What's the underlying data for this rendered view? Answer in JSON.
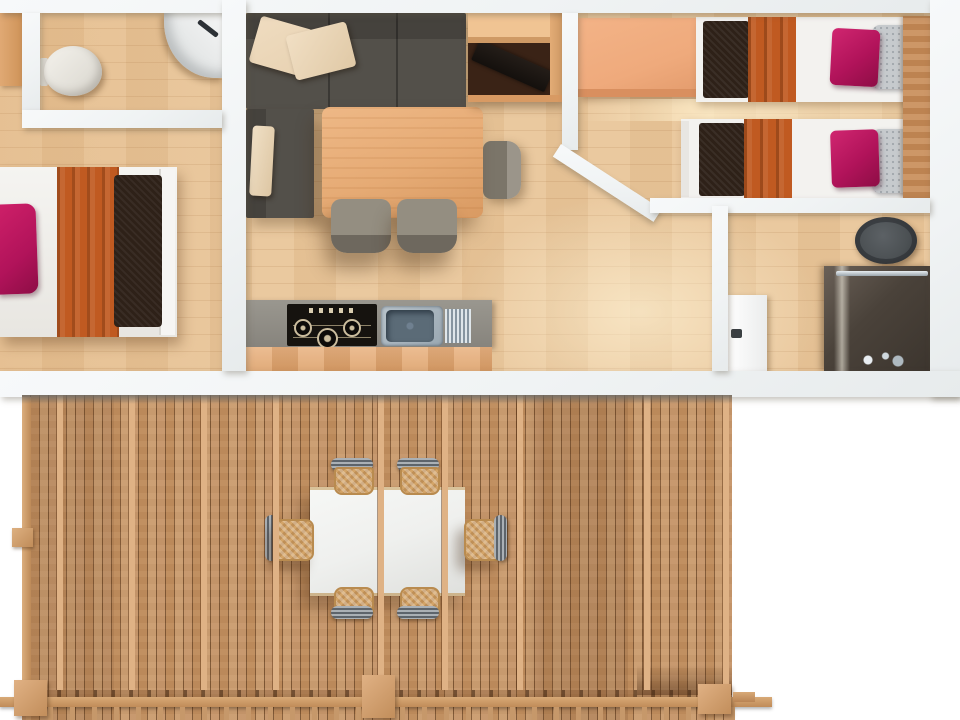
{
  "scene": {
    "type": "floor-plan-3d-top-view",
    "title": "Mobile home floor plan with wooden deck, top-down render",
    "visible_text": "none"
  },
  "palette": {
    "wall": "#f0f3f4",
    "floor": "#e9c69a",
    "deck_wood": "#c3905e",
    "deck_beam": "#dfb285",
    "sofa": "#4b4842",
    "cushion": "#e8d2b2",
    "table_wood": "#e6ab75",
    "chair_gray": "#8e887b",
    "counter": "#8f8c85",
    "hob": "#16130f",
    "steel": "#9aa8b2",
    "wardrobe": "#efaa7c",
    "cabinet_dark": "#3a2316",
    "bed_white": "#f3f2ef",
    "pillow_magenta": "#b1135a",
    "blanket_orange": "#c05a21",
    "runner_brown": "#2e2118",
    "pillow_gray": "#c6cacd",
    "headboard": "#c98e5a",
    "fixture_dark": "#4c5154",
    "glass_dark": "#4a423a",
    "chrome": "#e7edf1",
    "outdoor_table": "#eff0ee",
    "wicker": "#d3a468"
  },
  "rooms": [
    {
      "id": "wc",
      "label": "WC with toilet and corner basin"
    },
    {
      "id": "bedroom-double",
      "label": "Double bedroom"
    },
    {
      "id": "living-kitchen",
      "label": "Living room with kitchenette and dining table"
    },
    {
      "id": "bedroom-twin",
      "label": "Twin bedroom with wardrobe"
    },
    {
      "id": "shower-room",
      "label": "Shower room with toilet"
    },
    {
      "id": "deck",
      "label": "Covered wooden deck"
    }
  ],
  "furniture": {
    "wc": [
      "toilet",
      "corner-basin"
    ],
    "bedroom_double": [
      "double-bed",
      "magenta-pillow",
      "orange-blanket",
      "dark-runner"
    ],
    "living_kitchen": [
      "l-shaped-sofa",
      "beige-cushions",
      "dining-table",
      "gray-chairs",
      "media-cabinet-with-laptop",
      "kitchen-counter",
      "gas-hob",
      "stainless-sink"
    ],
    "bedroom_twin": [
      "wardrobe",
      "twin-bed-1",
      "twin-bed-2",
      "headboard-panel"
    ],
    "shower_room": [
      "dark-toilet",
      "shower-enclosure",
      "white-door"
    ],
    "deck": [
      "white-dining-table",
      "six-wicker-chairs",
      "railing",
      "posts",
      "pergola-beams"
    ]
  }
}
